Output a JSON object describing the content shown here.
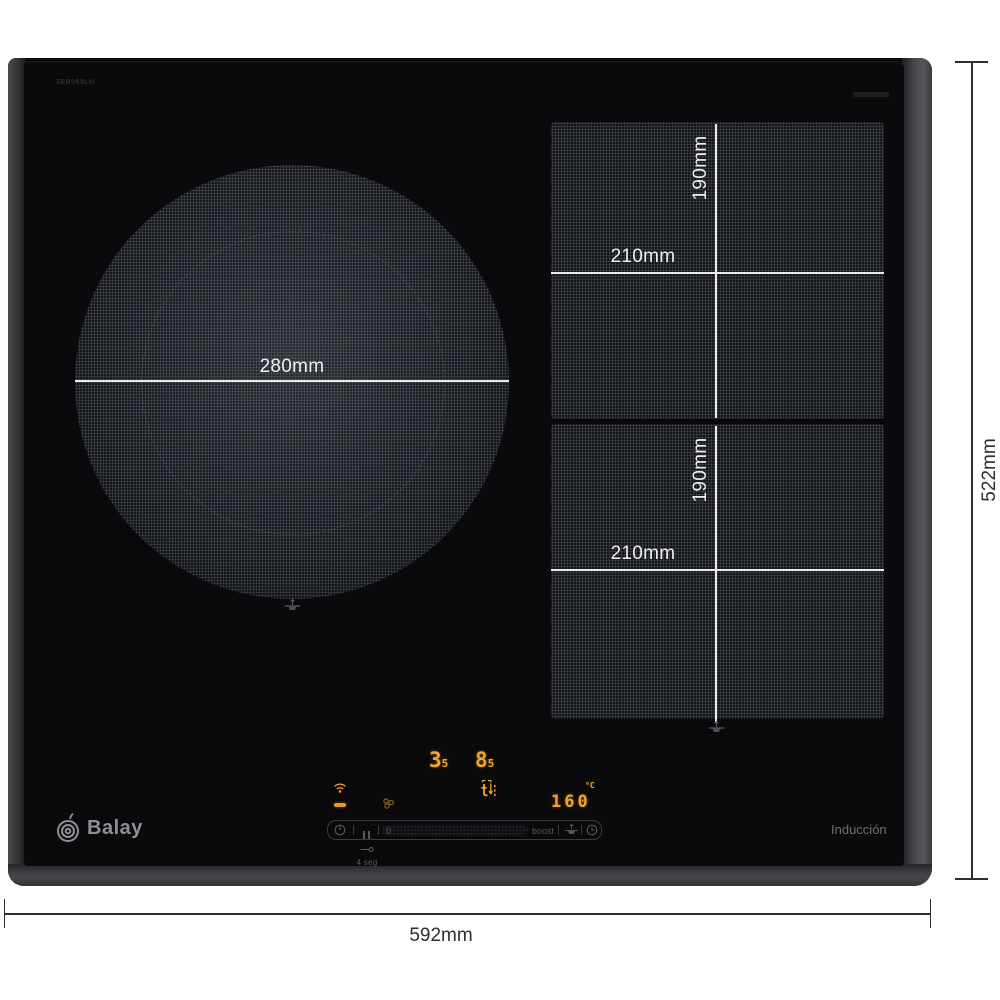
{
  "product": {
    "model": "3EB969LH",
    "brand": "Balay",
    "technology": "Inducción"
  },
  "dimensions": {
    "overall_width": "592mm",
    "overall_depth": "522mm",
    "round_zone_diameter": "280mm",
    "flex_zone_width": "210mm",
    "flex_zone_height": "190mm"
  },
  "control_panel": {
    "left_zone_power": {
      "main": "3",
      "half": "5"
    },
    "right_zone_power": {
      "main": "8",
      "half": "5"
    },
    "temperature": {
      "value": "160",
      "unit": "°C"
    },
    "slider": {
      "min": "0",
      "boost": "boost"
    },
    "lock_hint": "4 seg"
  },
  "colors": {
    "led_orange": "#f2a22e",
    "led_dim": "#e8992b",
    "zone_line": "#e9e9ea",
    "dim_line": "#2f2f2f"
  }
}
